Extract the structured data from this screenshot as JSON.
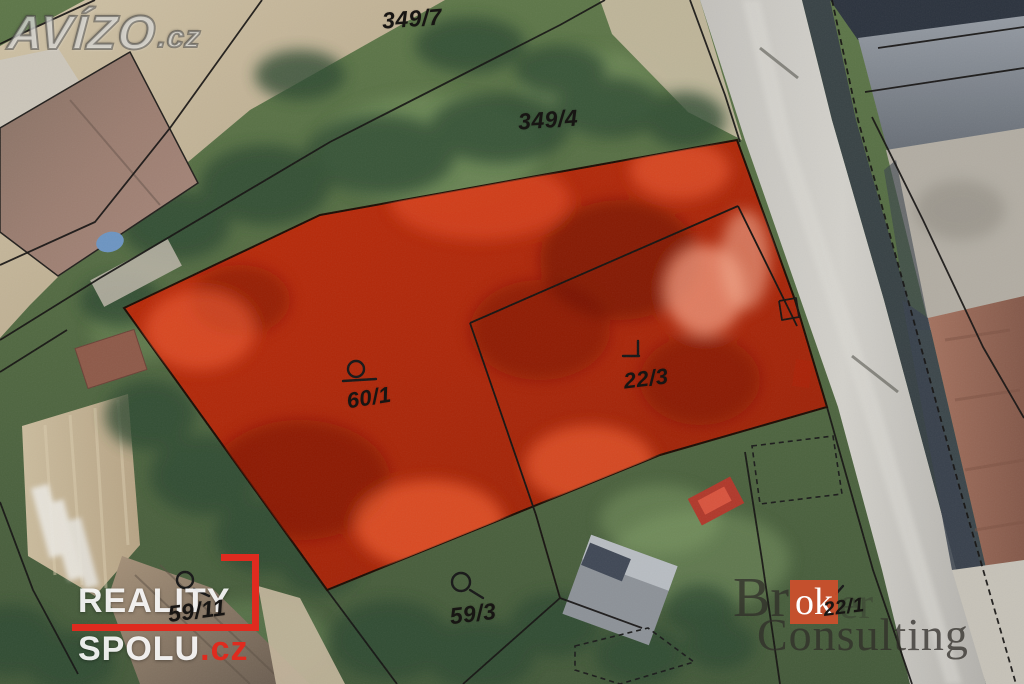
{
  "watermarks": {
    "avizo": {
      "text": "AVÍZO",
      "suffix": ".cz"
    },
    "reality_spolu": {
      "line1": "REALITY",
      "line2": "SPOLU",
      "suffix": ".cz",
      "accent_color": "#df2b1f"
    },
    "broker_consulting": {
      "prefix": "Br",
      "highlight": "ok",
      "rest": "er",
      "line2": "Consulting",
      "accent_color": "#cf4f2d"
    }
  },
  "map": {
    "type": "cadastral-aerial",
    "highlight_color": "#c62908",
    "highlighted_parcels": [
      "60/1",
      "22/3"
    ],
    "parcels": [
      {
        "label": "349/7",
        "symbol": null
      },
      {
        "label": "349/4",
        "symbol": null
      },
      {
        "label": "60/1",
        "symbol": "circle-tail"
      },
      {
        "label": "22/3",
        "symbol": "corner"
      },
      {
        "label": "59/11",
        "symbol": "circle-tail"
      },
      {
        "label": "59/3",
        "symbol": "circle-tail"
      },
      {
        "label": "22/1",
        "symbol": "tick"
      }
    ]
  }
}
